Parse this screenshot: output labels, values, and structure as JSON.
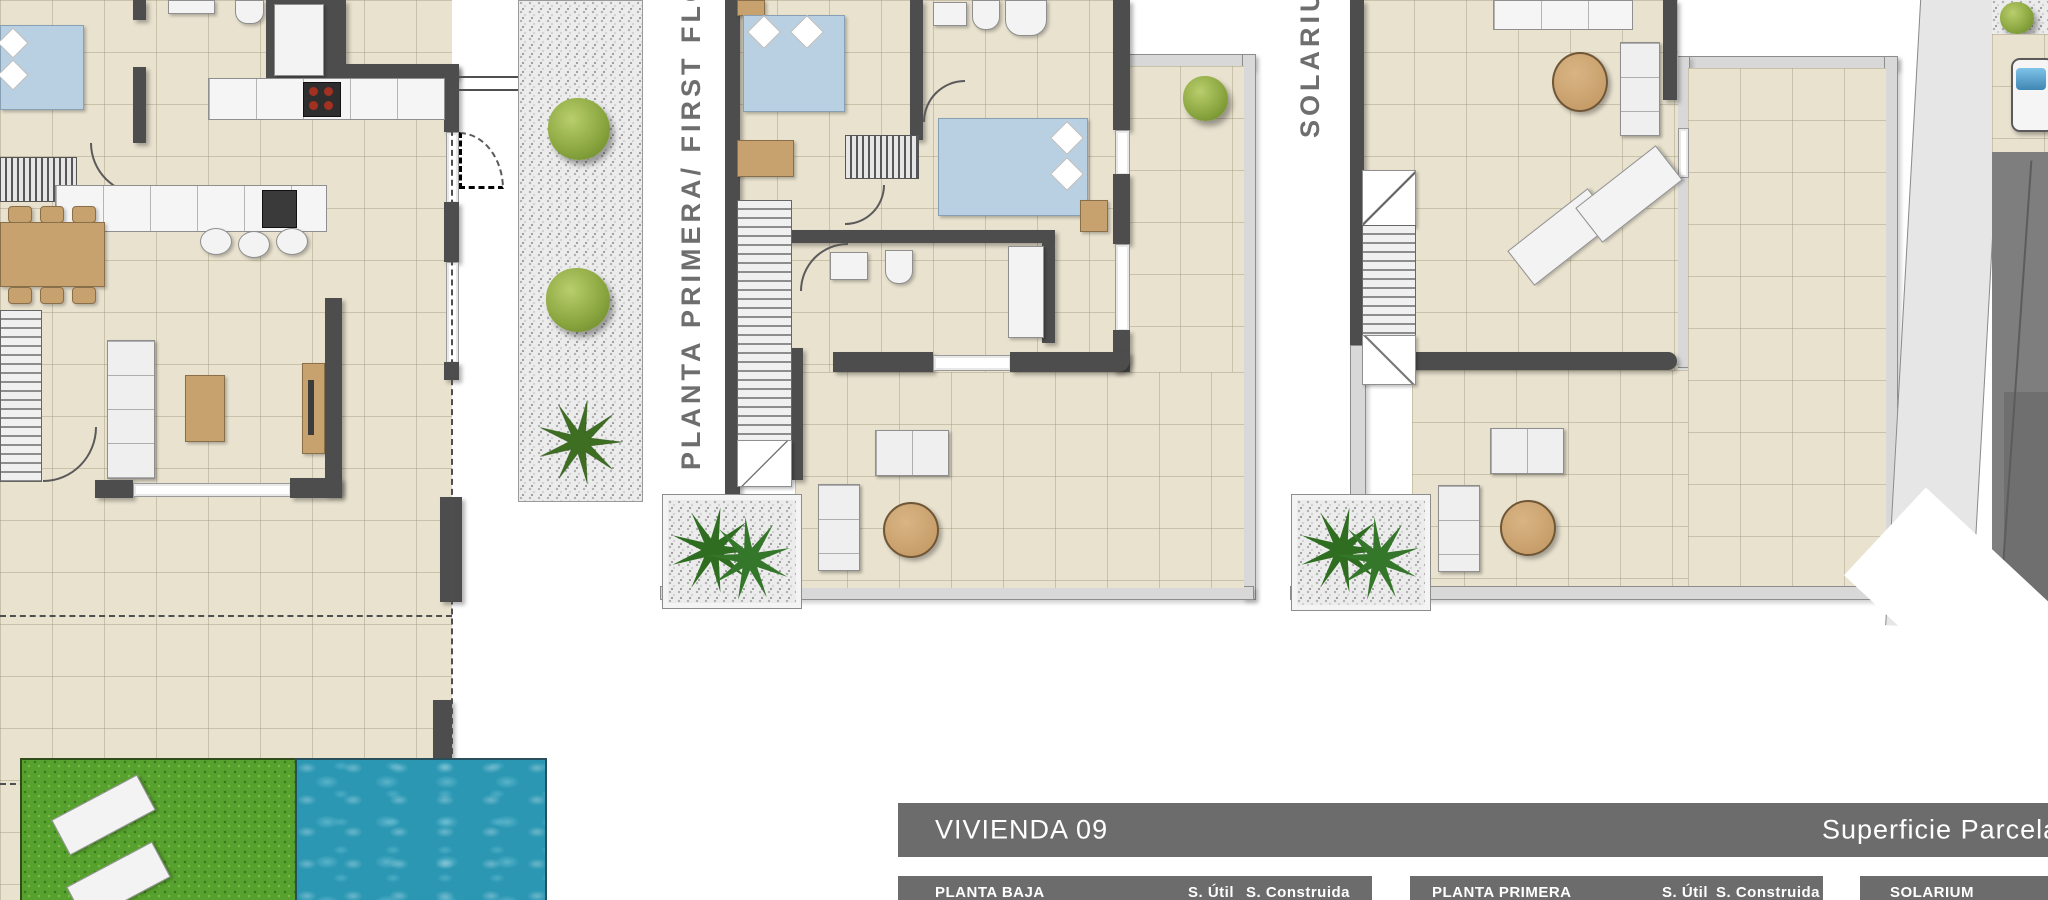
{
  "plan_labels": {
    "first_floor": "PLANTA PRIMERA/ FIRST FLOOR",
    "solarium": "SOLARIUM"
  },
  "header": {
    "title": "VIVIENDA 09",
    "right": "Superficie Parcela"
  },
  "tables": [
    {
      "title": "PLANTA BAJA",
      "col_util": "S. Útil",
      "col_built": "S. Construida"
    },
    {
      "title": "PLANTA PRIMERA",
      "col_util": "S. Útil",
      "col_built": "S. Construida"
    },
    {
      "title": "SOLARIUM",
      "col_util": "",
      "col_built": ""
    }
  ],
  "colors": {
    "bar_gray": "#6c6c6c",
    "wall_gray": "#4d4d4d",
    "tile_beige": "#e9e2cf",
    "pool_teal": "#2b97b3",
    "grass_green": "#57a12e",
    "bed_blue": "#b9d0e2",
    "wood_tan": "#c8a26e"
  }
}
